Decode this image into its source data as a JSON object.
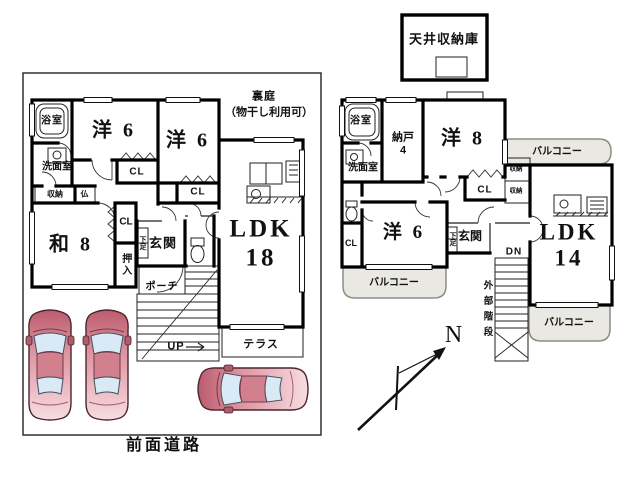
{
  "colors": {
    "wall": "#000000",
    "line": "#222222",
    "balcony_fill": "#e9e8e2",
    "balcony_border": "#8d8d85",
    "car_dark": "#bb5c6e",
    "car_mid": "#dd93a0",
    "car_light": "#f7dde0",
    "car_roof": "#d2808e",
    "car_window": "#d9e9f6"
  },
  "floor1": {
    "backyard": "裏庭",
    "backyard_note": "（物干し利用可）",
    "bath": "浴室",
    "washroom": "洗面室",
    "storage": "収納",
    "altar": "仏",
    "western1": "洋 6",
    "closet1": "CL",
    "western2": "洋 6",
    "closet2": "CL",
    "japanese": "和 8",
    "closet3": "CL",
    "oshiire": "押入",
    "shoe_cabinet": "下足",
    "entrance": "玄関",
    "porch": "ポーチ",
    "stairs_up": "UP",
    "ldk": "LDK\n18",
    "terrace": "テラス",
    "front_road": "前面道路"
  },
  "floor2": {
    "attic": "天井収納庫",
    "bath": "浴室",
    "washroom": "洗面室",
    "storage_room": "納戸\n4",
    "western8": "洋 8",
    "balcony_east": "バルコニー",
    "closet1": "CL",
    "storage_small1": "収納",
    "storage_small2": "収納",
    "western6": "洋 6",
    "closet2": "CL",
    "shoe_cabinet": "下足",
    "entrance": "玄関",
    "stairs_down": "DN",
    "external_stairs": "外部階段",
    "ldk": "LDK\n14",
    "balcony_west": "バルコニー",
    "balcony_south": "バルコニー",
    "compass_north": "N"
  }
}
